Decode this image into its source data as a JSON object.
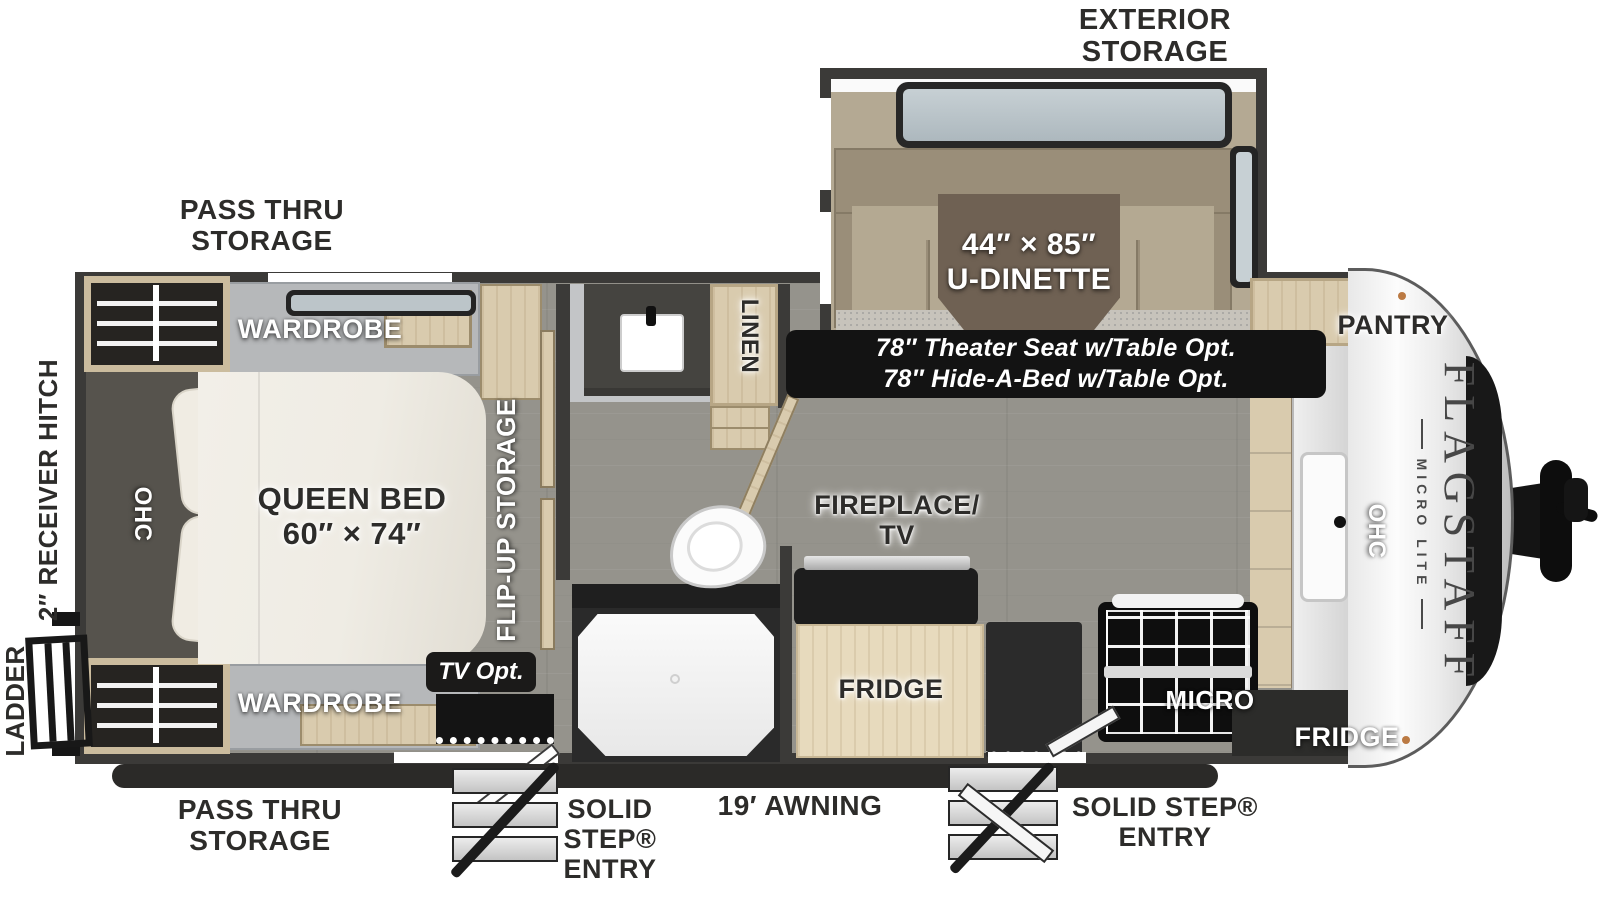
{
  "plan": {
    "title": "Flagstaff Micro Lite travel trailer floorplan",
    "brand": {
      "name": "FLAGSTAFF",
      "sub": "MICRO LITE"
    },
    "labels": {
      "exterior_storage": "EXTERIOR\nSTORAGE",
      "pass_thru_storage_top": "PASS THRU\nSTORAGE",
      "pass_thru_storage_bottom": "PASS THRU\nSTORAGE",
      "receiver_hitch": "2″ RECEIVER HITCH",
      "ladder": "LADDER",
      "wardrobe_top": "WARDROBE",
      "wardrobe_bottom": "WARDROBE",
      "queen_bed": "QUEEN BED\n60″ × 74″",
      "ohc_bedroom": "OHC",
      "flip_up_storage": "FLIP-UP STORAGE",
      "tv_option": "TV Opt.",
      "linen": "LINEN",
      "u_dinette": "44″ × 85″\nU-DINETTE",
      "theater_seat_option": "78″ Theater Seat w/Table Opt.",
      "hide_a_bed_option": "78″ Hide-A-Bed w/Table Opt.",
      "fireplace_tv": "FIREPLACE/\nTV",
      "fridge_interior": "FRIDGE",
      "micro": "MICRO",
      "fridge_front": "FRIDGE",
      "pantry": "PANTRY",
      "ohc_kitchen": "OHC",
      "solid_step_entry_bedroom_door": "SOLID\nSTEP®\nENTRY",
      "awning": "19′ AWNING",
      "solid_step_entry_main_door": "SOLID STEP®\nENTRY"
    },
    "colors": {
      "wall": "#3b3a38",
      "floor": "#95938c",
      "wood": "#d9cbae",
      "cushion_back": "#9a8e79",
      "cushion_seat": "#b4a992",
      "table": "#6f6153",
      "mattress": "#efece4",
      "label_dark": "#2d2c2a",
      "badge": "#1b1a19",
      "carpet": "#c7c3bb",
      "glass": "#c7d0d4",
      "awning_bar": "#2b2a28"
    }
  }
}
